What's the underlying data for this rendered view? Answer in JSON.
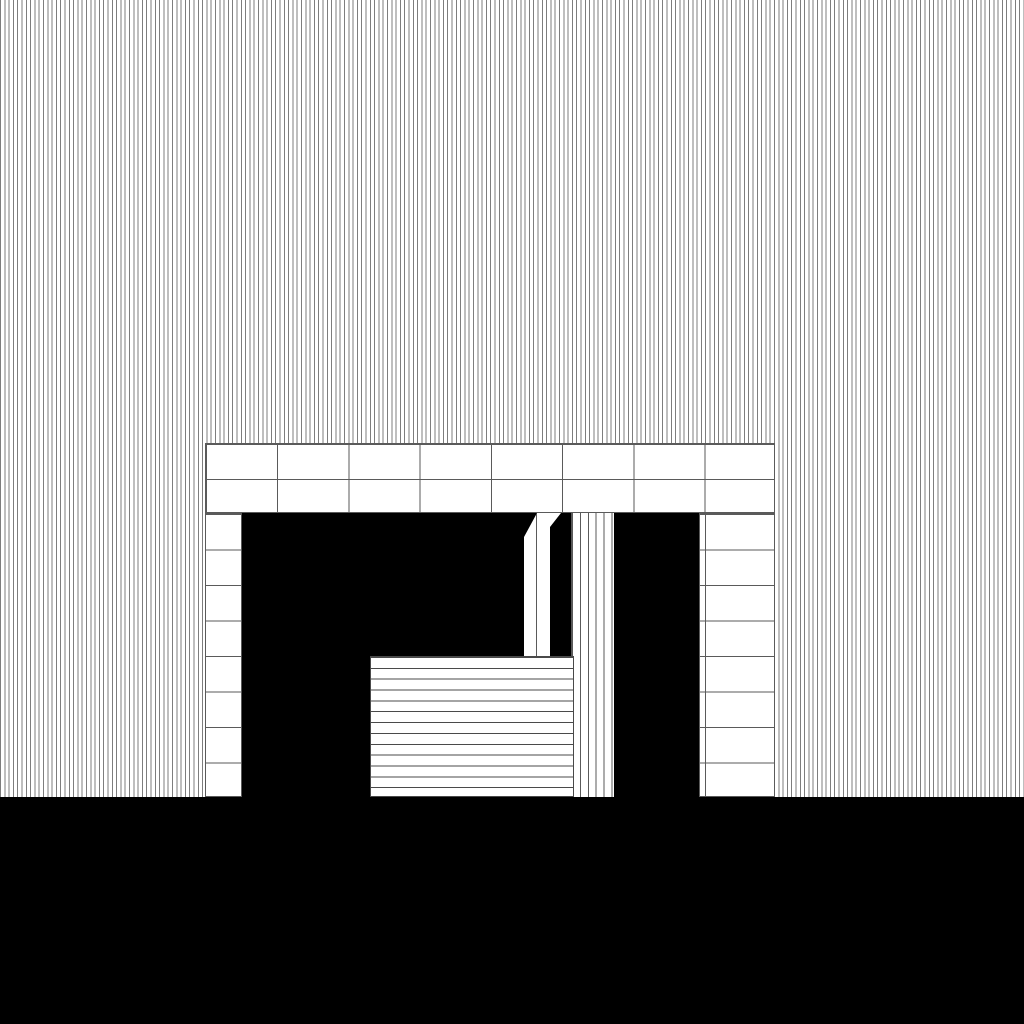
{
  "meta": {
    "description": "Abstract black-and-white architectural elevation drawing: a finely hatched backdrop, a gridded portal frame with a black doorway opening, a chamfered white post, a vertically striped pillar, a horizontally slatted crate, and a solid black ground band."
  },
  "colors": {
    "background": "#ffffff",
    "ink": "#000000",
    "hatch_line": "#7d7d7d",
    "grid_line": "#5a5a5a",
    "slat_line": "#4a4a4a"
  },
  "patterns": {
    "background_hatch_period_px": 4.3,
    "lintel_column_period_px": 71.25,
    "lintel_row_period_px": 35,
    "jamb_row_period_px": 35.5,
    "pillar_stripe_period_px": 7.9,
    "crate_slat_period_px": 10.85
  },
  "elements": [
    {
      "name": "hatched-sky",
      "fill": "vertical hatching"
    },
    {
      "name": "lintel-grid",
      "fill": "2 rows x 8 columns of white blocks"
    },
    {
      "name": "left-jamb",
      "fill": "8 stacked white blocks"
    },
    {
      "name": "right-jamb",
      "fill": "8 stacked white blocks with inner seam"
    },
    {
      "name": "door-opening",
      "fill": "solid black"
    },
    {
      "name": "chamfered-post",
      "fill": "white, diagonal top-left cut, center seam"
    },
    {
      "name": "post-wedge",
      "fill": "white triangle"
    },
    {
      "name": "striped-pillar",
      "fill": "vertical stripes"
    },
    {
      "name": "slatted-crate",
      "fill": "horizontal slats"
    },
    {
      "name": "ground-band",
      "fill": "solid black"
    }
  ]
}
